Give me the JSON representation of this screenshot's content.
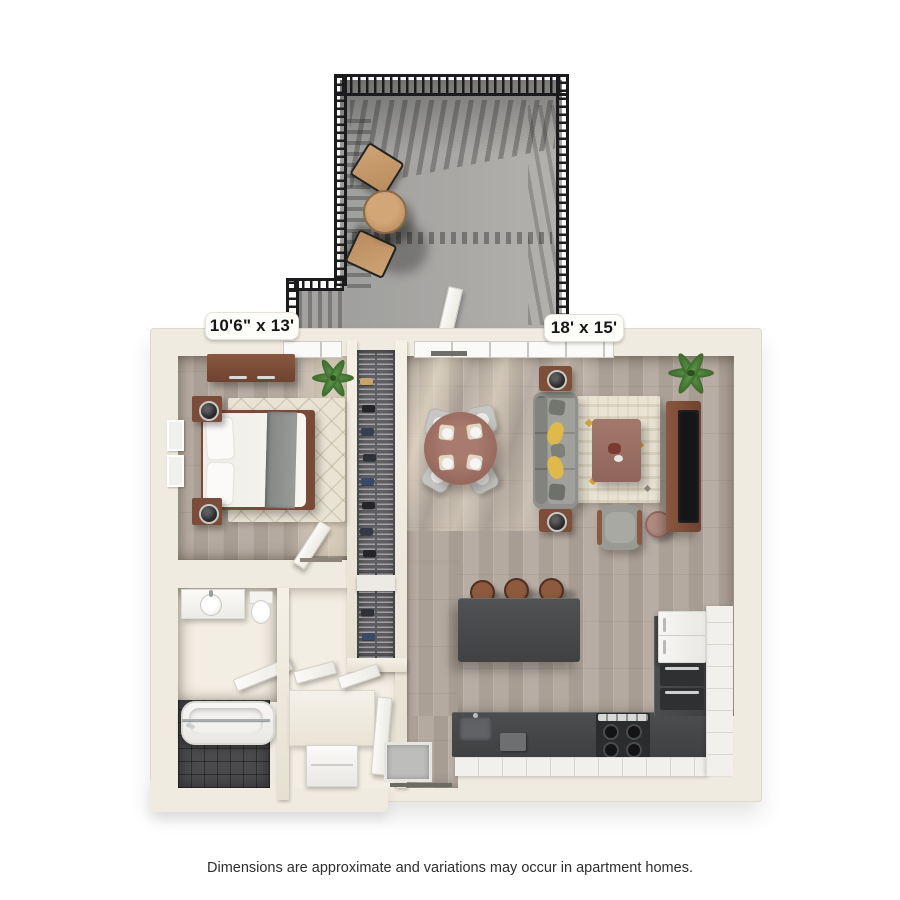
{
  "page": {
    "caption": "Dimensions are approximate and variations may occur in apartment homes."
  },
  "labels": {
    "bedroom": "10'6\" x 13'",
    "living_room": "18' x 15'"
  },
  "colors": {
    "wall": "#f0ebe0",
    "cream": "#f3eee3",
    "wood": "#b4a9a0",
    "wood-light": "#d9ccb7",
    "balcony": "#a9a8a6",
    "railing": "#1b1b1d",
    "counter": "#46484a",
    "cabinet": "#f1f0ed",
    "tile": "#4a4a4c",
    "rug": "#e9e3d4",
    "sofa": "#90918c",
    "furniture-wood": "#7b4c39",
    "accent-yellow": "#dfb94a",
    "mauve": "#9c7166",
    "label-bg": "#fdfdfa"
  }
}
